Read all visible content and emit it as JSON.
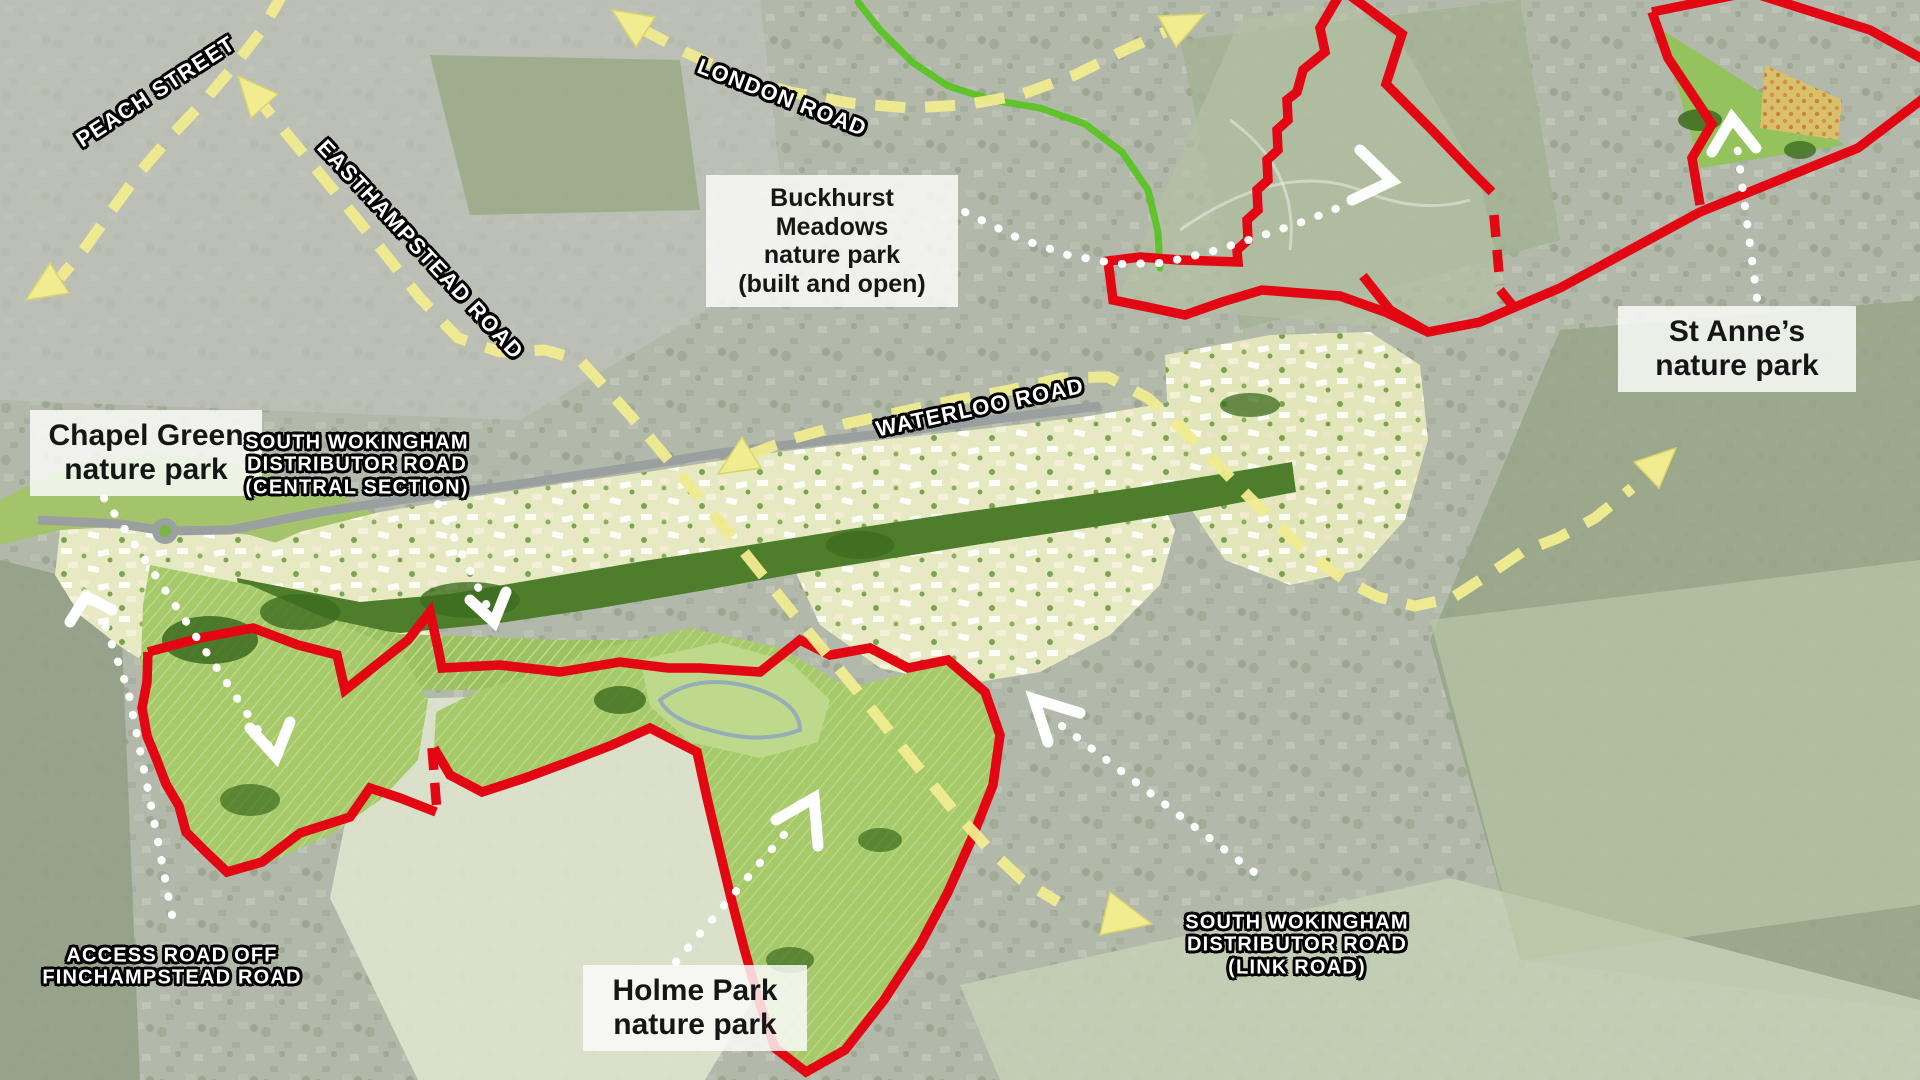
{
  "map": {
    "title": "South Wokingham development masterplan aerial map",
    "labels": {
      "buckhurst": {
        "l1": "Buckhurst Meadows",
        "l2": "nature park",
        "l3": "(built and open)"
      },
      "st_annes": {
        "l1": "St Anne’s",
        "l2": "nature park"
      },
      "chapel": {
        "l1": "Chapel Green",
        "l2": "nature park"
      },
      "holme": {
        "l1": "Holme Park",
        "l2": "nature park"
      }
    },
    "roads": {
      "peach": "PEACH STREET",
      "london": "LONDON ROAD",
      "easthampstead": "EASTHAMPSTEAD ROAD",
      "waterloo": "WATERLOO ROAD",
      "swdr_central": {
        "l1": "SOUTH WOKINGHAM",
        "l2": "DISTRIBUTOR ROAD",
        "l3": "(CENTRAL SECTION)"
      },
      "swdr_link": {
        "l1": "SOUTH WOKINGHAM",
        "l2": "DISTRIBUTOR ROAD",
        "l3": "(LINK ROAD)"
      },
      "access": {
        "l1": "ACCESS ROAD OFF",
        "l2": "FINCHAMPSTEAD ROAD"
      }
    },
    "colors": {
      "boundary_red": "#e30613",
      "route_yellow": "#f1ec8f",
      "route_green": "#55c41e",
      "arrow_white": "#ffffff",
      "label_bg": "rgba(252,252,250,0.84)",
      "label_text": "#161616",
      "masterplan_green": "#a6ca69",
      "parcel_cream": "#e6e9c2"
    }
  }
}
